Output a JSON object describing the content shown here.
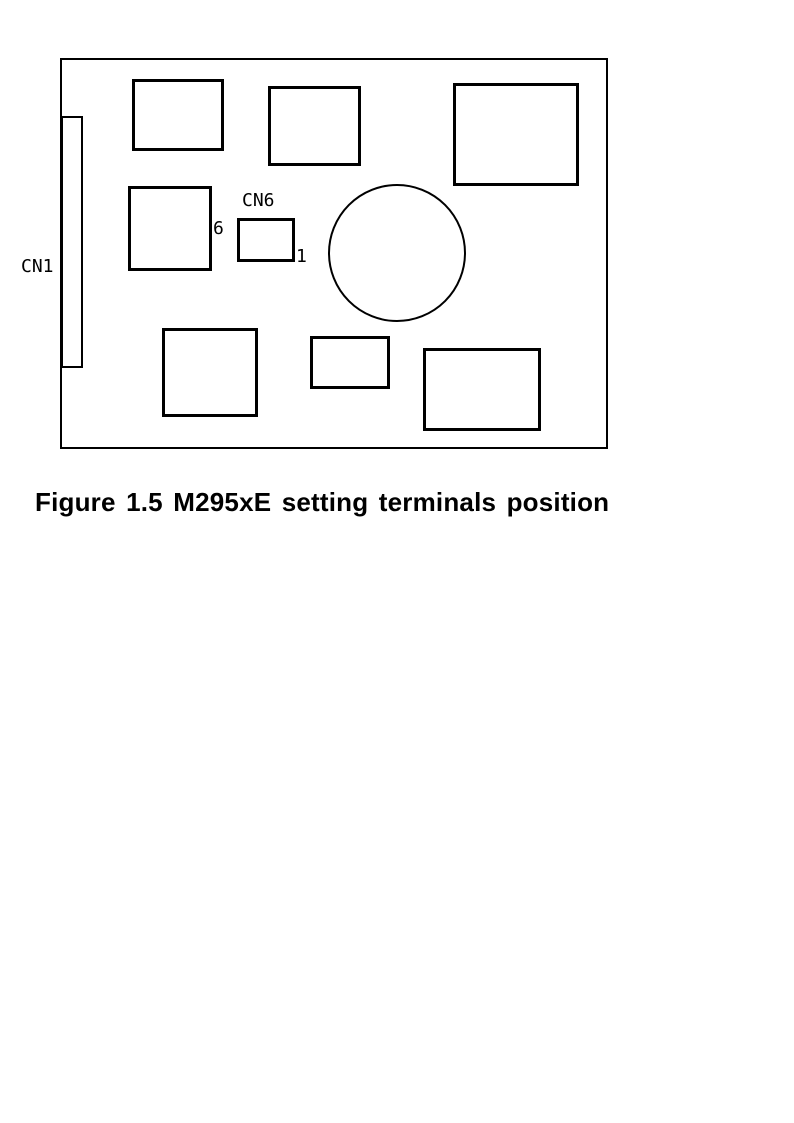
{
  "page": {
    "width": 794,
    "height": 1123,
    "background": "#ffffff"
  },
  "colors": {
    "line": "#000000",
    "text": "#000000"
  },
  "caption": {
    "text": "Figure 1.5 M295xE setting terminals position"
  },
  "labels": {
    "cn1": "CN1",
    "cn6": "CN6",
    "cn6_pin_top": "6",
    "cn6_pin_bottom": "1"
  },
  "diagram": {
    "description": "M295xE board top view showing setting terminal positions",
    "shapes": [
      {
        "name": "board-outline",
        "type": "rect",
        "x": 60,
        "y": 58,
        "w": 548,
        "h": 391,
        "stroke": 2
      },
      {
        "name": "cn1-connector",
        "type": "rect",
        "x": 61,
        "y": 116,
        "w": 22,
        "h": 252,
        "stroke": 2
      },
      {
        "name": "component-top-left",
        "type": "rect",
        "x": 132,
        "y": 79,
        "w": 92,
        "h": 72,
        "stroke": 3
      },
      {
        "name": "component-top-middle",
        "type": "rect",
        "x": 268,
        "y": 86,
        "w": 93,
        "h": 80,
        "stroke": 3
      },
      {
        "name": "component-top-right",
        "type": "rect",
        "x": 453,
        "y": 83,
        "w": 126,
        "h": 103,
        "stroke": 3
      },
      {
        "name": "component-mid-left",
        "type": "rect",
        "x": 128,
        "y": 186,
        "w": 84,
        "h": 85,
        "stroke": 3
      },
      {
        "name": "cn6-terminal-block",
        "type": "rect",
        "x": 237,
        "y": 218,
        "w": 58,
        "h": 44,
        "stroke": 3
      },
      {
        "name": "circular-component",
        "type": "circle",
        "x": 328,
        "y": 184,
        "w": 138,
        "h": 138,
        "stroke": 2
      },
      {
        "name": "component-bottom-left",
        "type": "rect",
        "x": 162,
        "y": 328,
        "w": 96,
        "h": 89,
        "stroke": 3
      },
      {
        "name": "component-bottom-middle",
        "type": "rect",
        "x": 310,
        "y": 336,
        "w": 80,
        "h": 53,
        "stroke": 3
      },
      {
        "name": "component-bottom-right",
        "type": "rect",
        "x": 423,
        "y": 348,
        "w": 118,
        "h": 83,
        "stroke": 3
      }
    ]
  }
}
